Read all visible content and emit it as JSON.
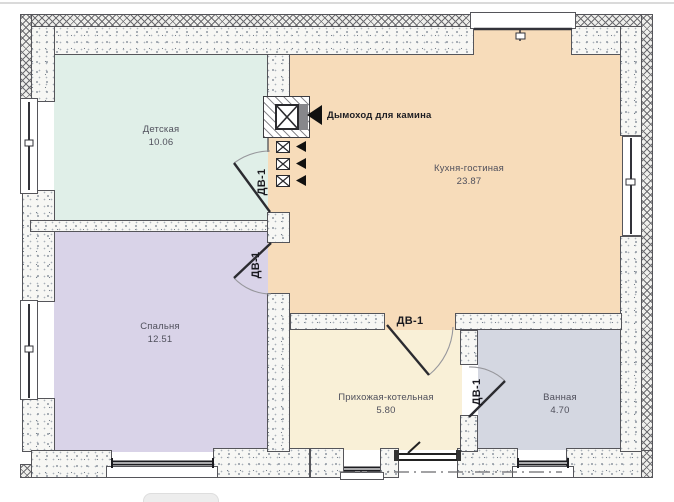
{
  "plan": {
    "rooms": [
      {
        "id": "detskaya",
        "name": "Детская",
        "area": "10.06",
        "color": "#e0efe8"
      },
      {
        "id": "kitchen-living",
        "name": "Кухня-гостиная",
        "area": "23.87",
        "color": "#f7dcba"
      },
      {
        "id": "bedroom",
        "name": "Спальня",
        "area": "12.51",
        "color": "#d9d3e8"
      },
      {
        "id": "hall-boiler",
        "name": "Прихожая-котельная",
        "area": "5.80",
        "color": "#f9f0d7"
      },
      {
        "id": "bathroom",
        "name": "Ванная",
        "area": "4.70",
        "color": "#d4d7e1"
      }
    ],
    "door_tag": "ДВ-1",
    "chimney_note": "Дымоход для камина",
    "line_color": "#55555a"
  },
  "footer": {
    "button_label": ""
  }
}
